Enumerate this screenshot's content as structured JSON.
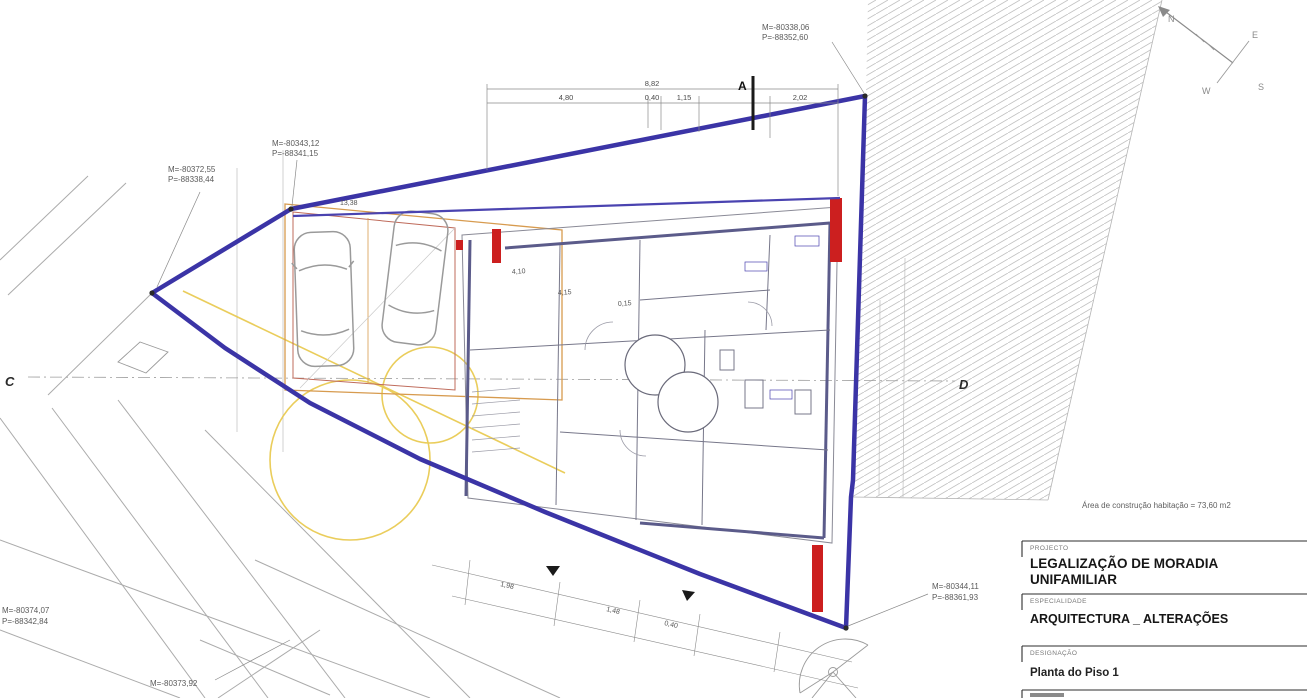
{
  "drawing": {
    "area_note": "Área de construção habitação = 73,60 m2",
    "title_block": {
      "rows": [
        {
          "label": "PROJECTO",
          "line1": "LEGALIZAÇÃO DE MORADIA",
          "line2": "UNIFAMILIAR"
        },
        {
          "label": "ESPECIALIDADE",
          "line1": "ARQUITECTURA _ ALTERAÇÕES"
        },
        {
          "label": "DESIGNAÇÃO",
          "line1": "Planta do Piso 1"
        }
      ]
    },
    "survey_points": [
      {
        "m": "M=-80338,06",
        "p": "P=-88352,60"
      },
      {
        "m": "M=-80343,12",
        "p": "P=-88341,15"
      },
      {
        "m": "M=-80372,55",
        "p": "P=-88338,44"
      },
      {
        "m": "M=-80374,07",
        "p": "P=-88342,84"
      },
      {
        "m": "M=-80373,92",
        "p": ""
      },
      {
        "m": "M=-80344,11",
        "p": "P=-88361,93"
      }
    ],
    "section_markers": {
      "a": "A",
      "c": "C",
      "d": "D"
    },
    "compass": {
      "n": "N",
      "e": "E",
      "s": "S",
      "w": "W"
    },
    "dimensions": {
      "top_total": "8,82",
      "top_chain": [
        "4,80",
        "0,40",
        "1,15",
        "2,02"
      ],
      "interior": [
        "4,10",
        "4,15",
        "0,15"
      ],
      "garage_width": "13,38",
      "bottom_chain": [
        "1,98",
        "1,48",
        "0,40"
      ]
    },
    "colors": {
      "boundary_blue": "#3b34a6",
      "garage_orange": "#d79b4f",
      "garage_brown": "#bf6b5b",
      "marker_red": "#cc1f1f",
      "template_yellow": "#e8c84a",
      "hatch_gray": "#c4c4c4"
    }
  }
}
